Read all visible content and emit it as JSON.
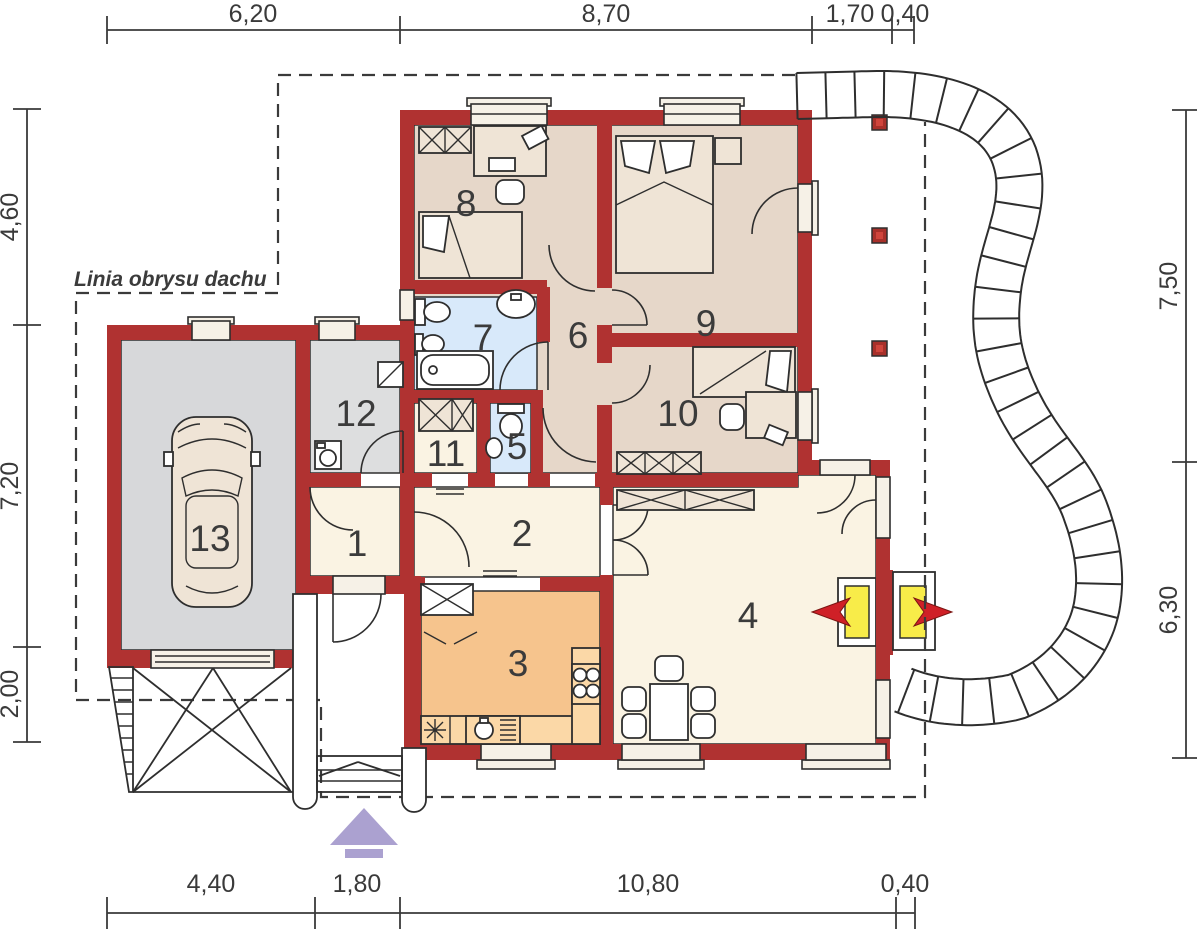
{
  "drawing": {
    "roof_outline_label": "Linia obrysu dachu",
    "room_numbers": [
      "1",
      "2",
      "3",
      "4",
      "5",
      "6",
      "7",
      "8",
      "9",
      "10",
      "11",
      "12",
      "13"
    ],
    "dimensions": {
      "top": [
        "6,20",
        "8,70",
        "1,70",
        "0,40"
      ],
      "bottom": [
        "4,40",
        "1,80",
        "10,80",
        "0,40"
      ],
      "left": [
        "4,60",
        "7,20",
        "2,00"
      ],
      "right": [
        "7,50",
        "6,30"
      ]
    },
    "colors": {
      "wall": "#b03231",
      "line": "#2e2e2e",
      "bedroom_floor": "#e6d7c9",
      "cream_floor": "#faf3e3",
      "kitchen_floor": "#f6c48d",
      "counter": "#fbd8a7",
      "bath_floor": "#d8e9fa",
      "garage_floor": "#d7d8da",
      "utility_floor": "#dddedf",
      "window_fill": "#f6f1e7",
      "furniture_fill": "#efe4d6",
      "fireplace_yellow": "#f8ec49",
      "flame_red": "#cf2027",
      "entry_arrow": "#aba1d0",
      "post_red": "#a8302a",
      "dim_text": "#3a3a3a"
    }
  }
}
